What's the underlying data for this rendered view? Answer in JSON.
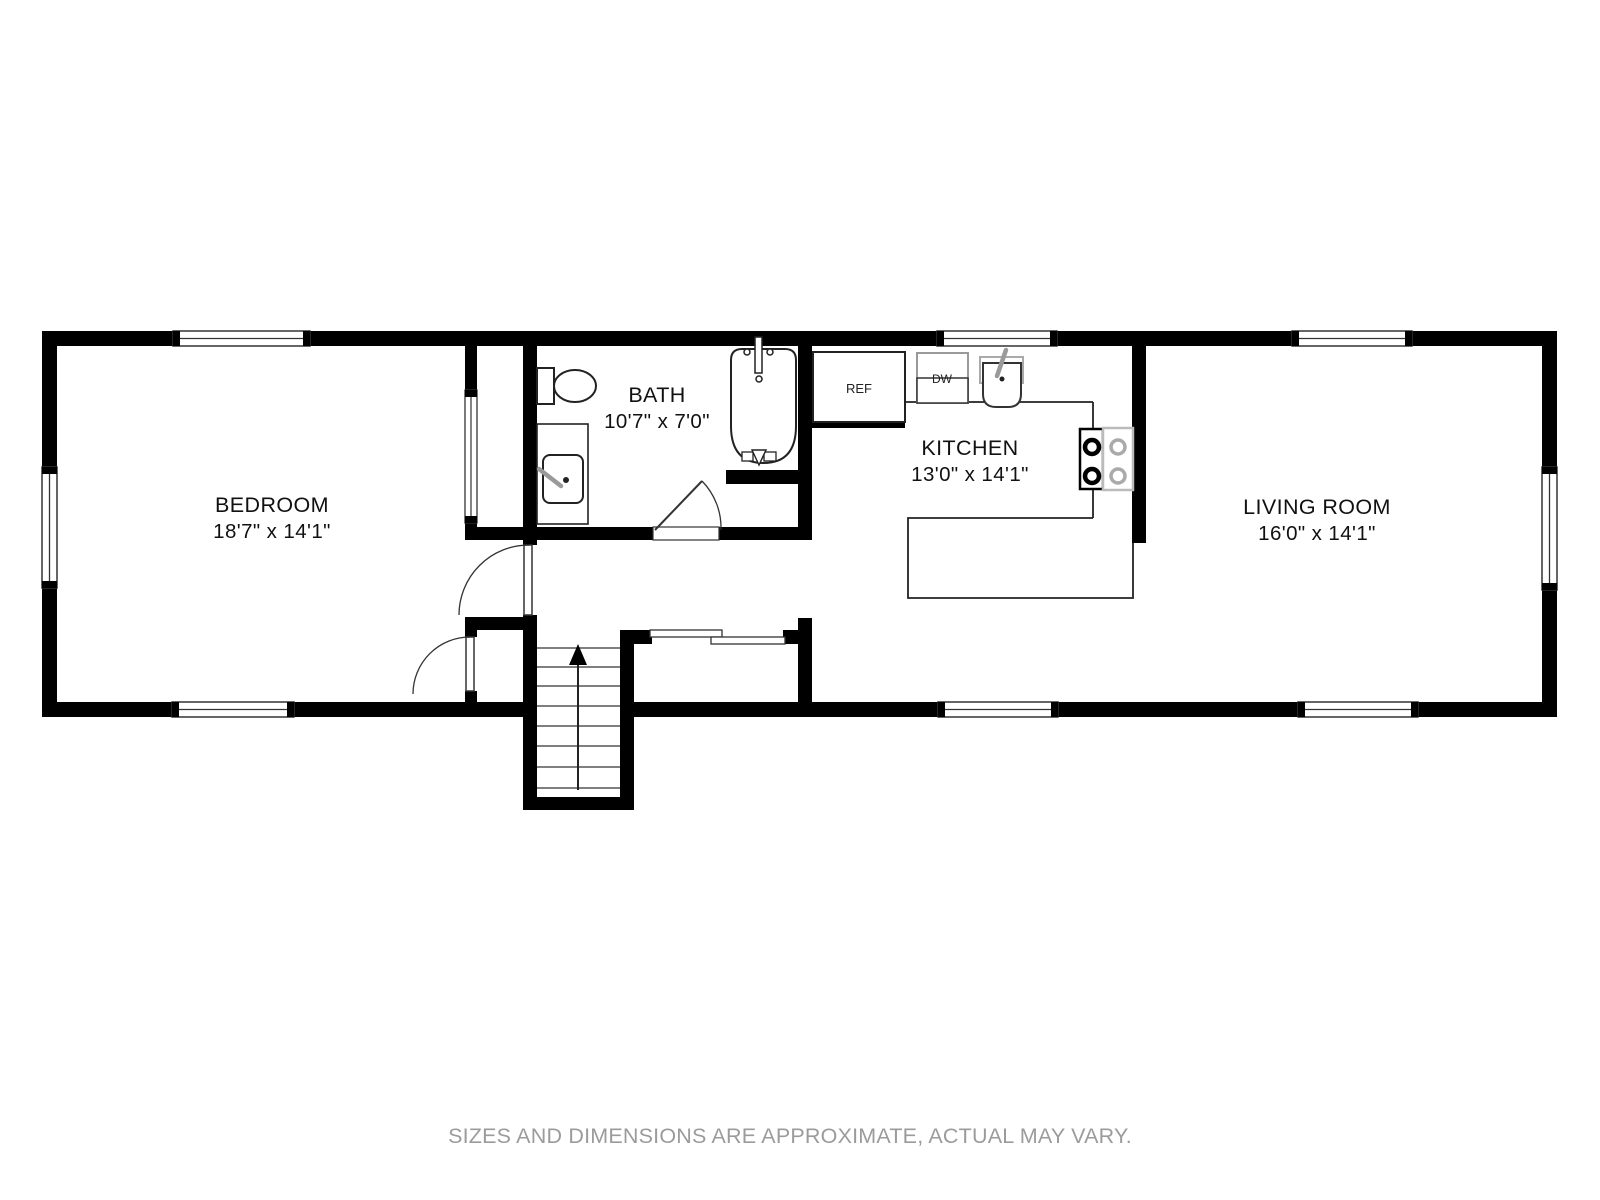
{
  "page": {
    "footer_note": "SIZES AND DIMENSIONS ARE APPROXIMATE, ACTUAL MAY VARY."
  },
  "floor_plan": {
    "rooms": [
      {
        "name": "BEDROOM",
        "dimensions": "18'7\" x 14'1\""
      },
      {
        "name": "BATH",
        "dimensions": "10'7\" x 7'0\""
      },
      {
        "name": "KITCHEN",
        "dimensions": "13'0\" x 14'1\""
      },
      {
        "name": "LIVING ROOM",
        "dimensions": "16'0\" x 14'1\""
      }
    ],
    "appliances": {
      "refrigerator": "REF",
      "dishwasher": "DW"
    },
    "features": [
      "stairs-up",
      "bathtub",
      "toilet",
      "vanity-sink",
      "kitchen-sink",
      "stove",
      "sliding-door-closet",
      "closet",
      "windows",
      "doors"
    ],
    "colors": {
      "wall": "#000000",
      "line": "#222222",
      "fixture_gray": "#a8a8a8",
      "footer": "#9b9b9b",
      "background": "#ffffff"
    }
  }
}
